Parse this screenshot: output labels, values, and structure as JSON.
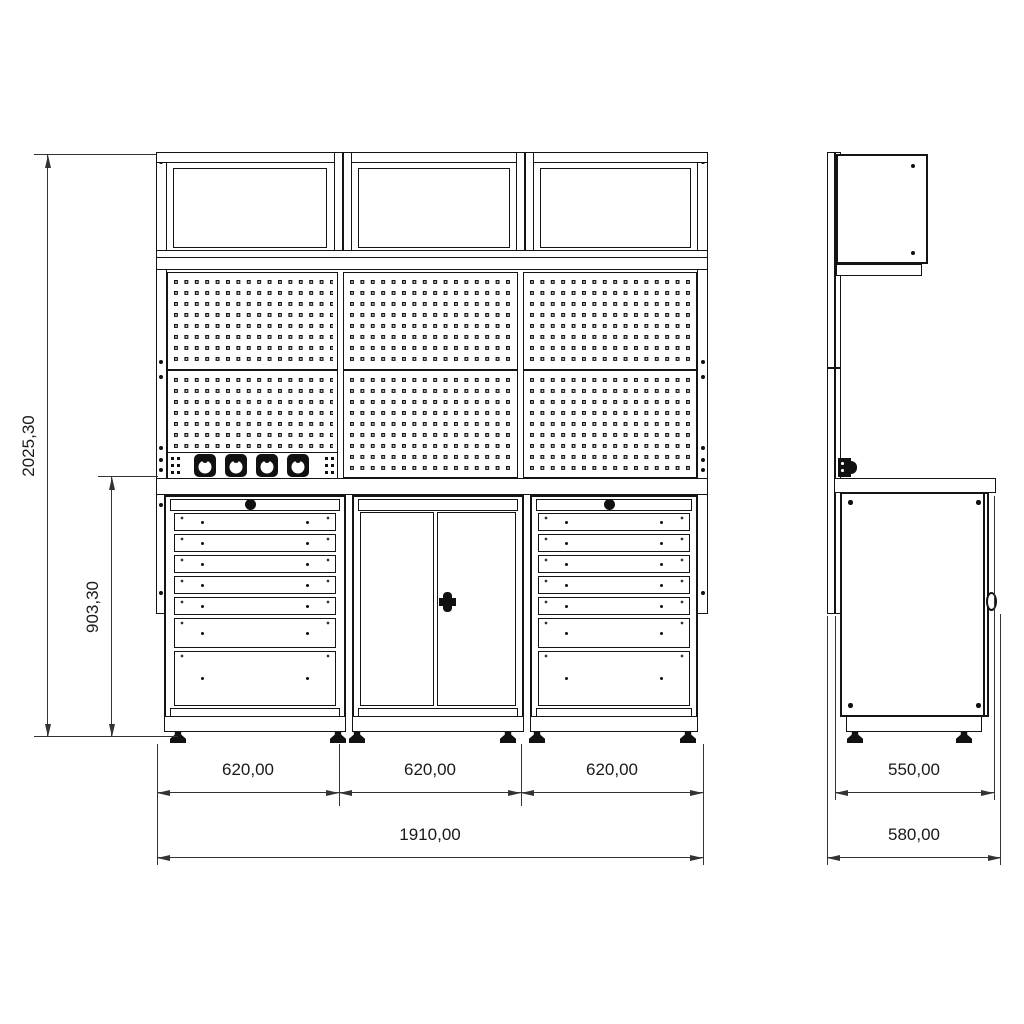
{
  "dimensions": {
    "front": {
      "module_widths": [
        "620,00",
        "620,00",
        "620,00"
      ],
      "total_width": "1910,00",
      "overall_height": "2025,30",
      "cabinet_height": "903,30"
    },
    "side": {
      "worktop_depth": "550,00",
      "overall_depth": "580,00"
    }
  },
  "icons": {
    "power_socket": "round industrial socket",
    "drawer_knob": "round black knob",
    "door_lock": "cam lock",
    "levelling_foot": "adjustable foot"
  },
  "colors": {
    "line": "#141414",
    "dimension_line": "#333333",
    "background": "#ffffff"
  }
}
